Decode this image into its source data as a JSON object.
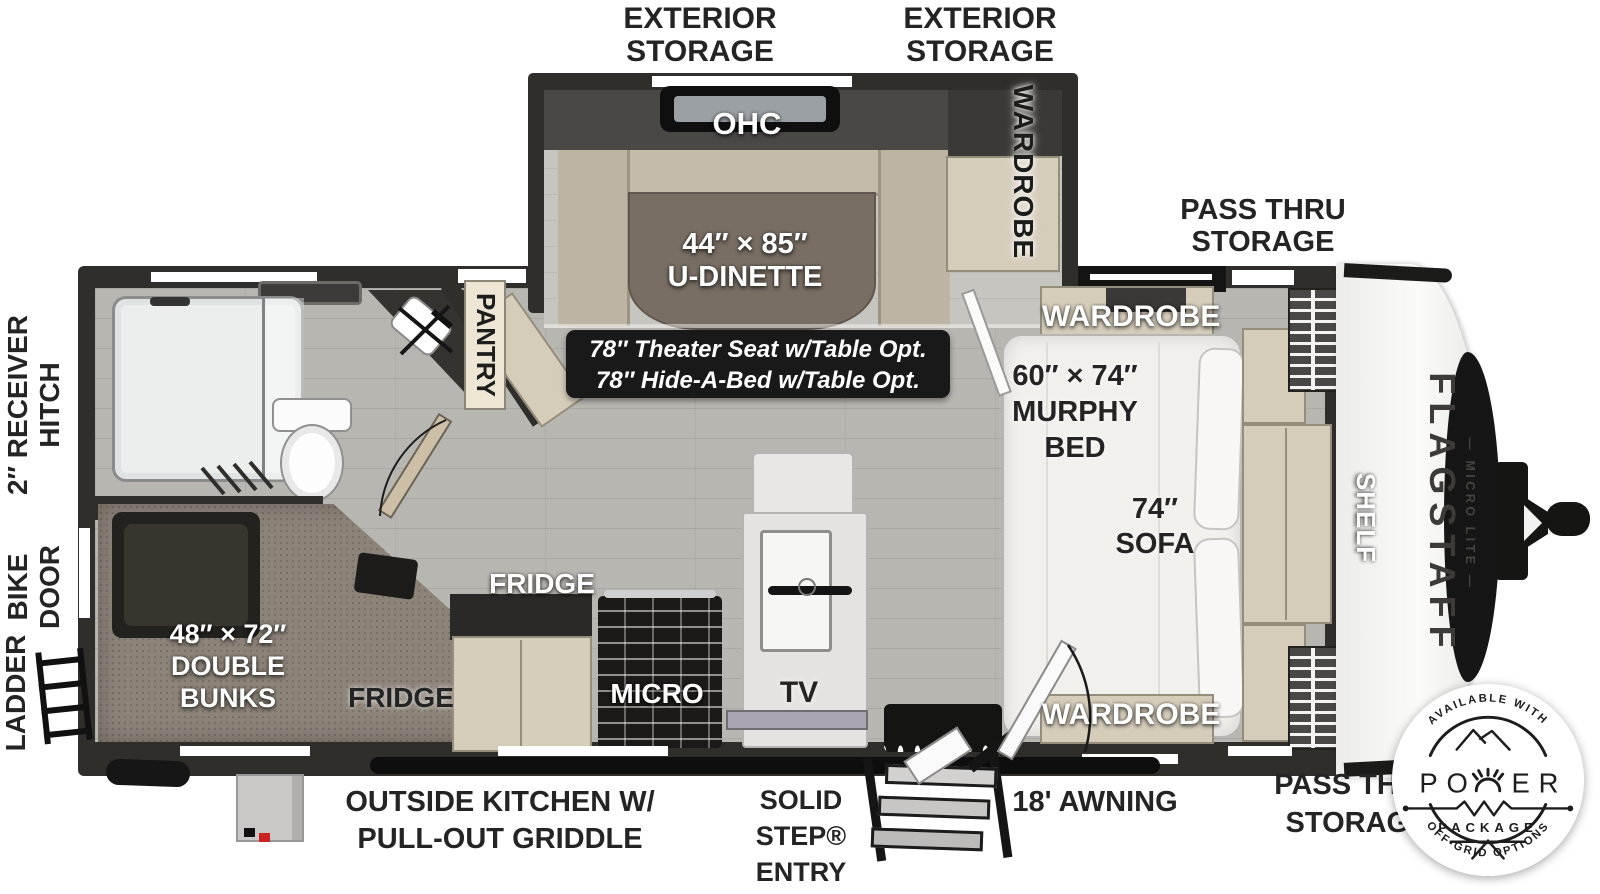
{
  "floorplan": {
    "top": {
      "exterior_storage_1": {
        "line1": "EXTERIOR",
        "line2": "STORAGE"
      },
      "exterior_storage_2": {
        "line1": "EXTERIOR",
        "line2": "STORAGE"
      },
      "pass_thru_storage": {
        "line1": "PASS THRU",
        "line2": "STORAGE"
      }
    },
    "left": {
      "receiver_hitch": {
        "line1": "2″ RECEIVER",
        "line2": "HITCH"
      },
      "bike_door": {
        "line1": "BIKE",
        "line2": "DOOR"
      },
      "ladder": "LADDER"
    },
    "bottom": {
      "outside_kitchen": {
        "line1": "OUTSIDE KITCHEN W/",
        "line2": "PULL-OUT GRIDDLE"
      },
      "solid_step": {
        "line1": "SOLID",
        "line2": "STEP®",
        "line3": "ENTRY"
      },
      "awning": "18' AWNING",
      "pass_thru_storage": {
        "line1": "PASS THRU",
        "line2": "STORAGE"
      }
    },
    "rooms": {
      "ohc": "OHC",
      "slide_wardrobe": "WARDROBE",
      "dinette": {
        "line1": "44″ × 85″",
        "line2": "U-DINETTE"
      },
      "theater_option": {
        "line1": "78″ Theater Seat w/Table Opt.",
        "line2": "78″ Hide-A-Bed w/Table Opt."
      },
      "pantry": "PANTRY",
      "wardrobe_top": "WARDROBE",
      "wardrobe_bottom": "WARDROBE",
      "murphy_bed": {
        "line1": "60″ × 74″",
        "line2": "MURPHY",
        "line3": "BED"
      },
      "sofa": {
        "line1": "74″",
        "line2": "SOFA"
      },
      "shelf": "SHELF",
      "double_bunks": {
        "line1": "48″ × 72″",
        "line2": "DOUBLE",
        "line3": "BUNKS"
      },
      "fridge_interior": "FRIDGE",
      "fridge_exterior": "FRIDGE",
      "micro": "MICRO",
      "tv": "TV"
    },
    "brand": {
      "name": "FLAGSTAFF",
      "series": "— MICRO LITE —"
    },
    "badge": {
      "arc_top": "AVAILABLE WITH",
      "power_left": "PO",
      "power_right": "ER",
      "package": "PACKAGE",
      "arc_bottom": "OFF-GRID OPTIONS"
    },
    "colors": {
      "wall": "#2f2e2b",
      "floor": "#b8b6b1",
      "cabinet": "#d5ccba",
      "table": "#786e63",
      "carpet": "#8d8479",
      "badge_bg": "#191919",
      "text_dark": "#242424",
      "text_light": "#ffffff"
    }
  }
}
